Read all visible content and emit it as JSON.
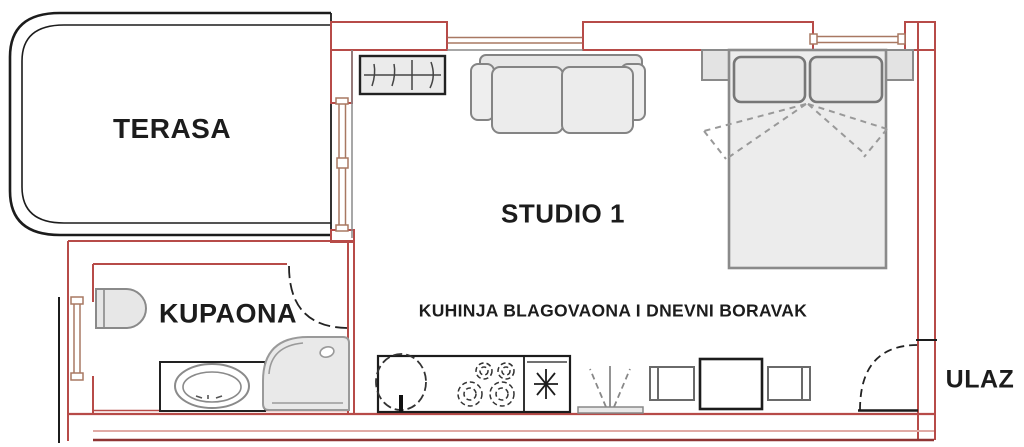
{
  "title": "Studio apartment floor plan",
  "rooms": {
    "terasa": "TERASA",
    "studio": "STUDIO 1",
    "kupaona": "KUPAONA",
    "kuhinja": "KUHINJA BLAGOVAONA I DNEVNI BORAVAK",
    "ulaz": "ULAZ"
  },
  "fixtures": [
    "radiator",
    "sofa",
    "double-bed",
    "pillows",
    "nightstand-left",
    "nightstand-right",
    "toilet",
    "vanity-sink",
    "shower",
    "kitchen-counter",
    "kitchen-sink",
    "stove-burners",
    "fridge-freezer",
    "plant",
    "chair-left",
    "dining-table",
    "chair-right",
    "bathroom-door",
    "entrance-door",
    "window-top-1",
    "window-top-2",
    "window-terrace",
    "window-bathroom"
  ],
  "colors": {
    "wall_red": "#b74b48",
    "wall_dark_red": "#8f3433",
    "wall_light_pink": "#e0aaa5",
    "window_frame": "#a87862",
    "outline_black": "#1c1c1c",
    "furniture_stroke": "#848484",
    "furniture_fill": "#eaeaea",
    "text": "#1c1c1c",
    "background": "#ffffff"
  }
}
